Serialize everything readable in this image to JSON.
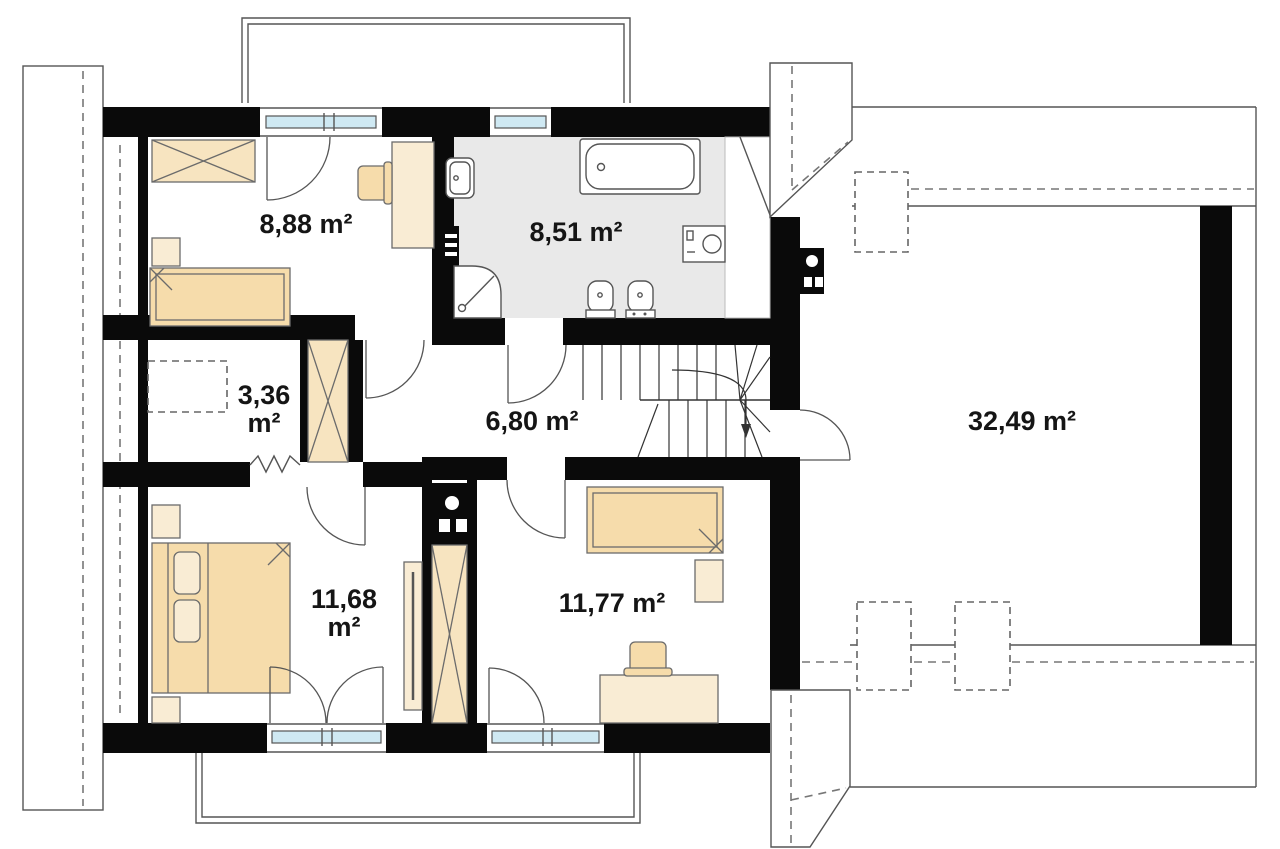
{
  "plan": {
    "type": "floor-plan",
    "storey": "attic",
    "unit": "m²",
    "rooms": [
      {
        "name": "bedroom-upper-left",
        "area": "8,88 m²"
      },
      {
        "name": "bathroom",
        "area": "8,51 m²"
      },
      {
        "name": "storage",
        "area_value": "3,36",
        "area_unit": "m²"
      },
      {
        "name": "hall",
        "area": "6,80 m²"
      },
      {
        "name": "bedroom-lower-left",
        "area_value": "11,68",
        "area_unit": "m²"
      },
      {
        "name": "bedroom-lower-right",
        "area": "11,77 m²"
      },
      {
        "name": "attic-open-space",
        "area": "32,49 m²"
      }
    ],
    "colors": {
      "wall": "#0a0a0a",
      "furniture_light": "#f9ecd4",
      "furniture_mid": "#f6dcab",
      "bathroom_floor": "#e9e9e9",
      "window_glass": "#cfe9f3",
      "outline": "#555555"
    },
    "symbols": [
      "wardrobe",
      "single-bed",
      "double-bed",
      "desk",
      "chair",
      "nightstand",
      "bathtub",
      "washbasin",
      "shower",
      "toilet",
      "bidet",
      "washing-machine",
      "radiator",
      "mirror-cabinet",
      "stairs",
      "chimney",
      "roof-outline",
      "balcony"
    ]
  }
}
